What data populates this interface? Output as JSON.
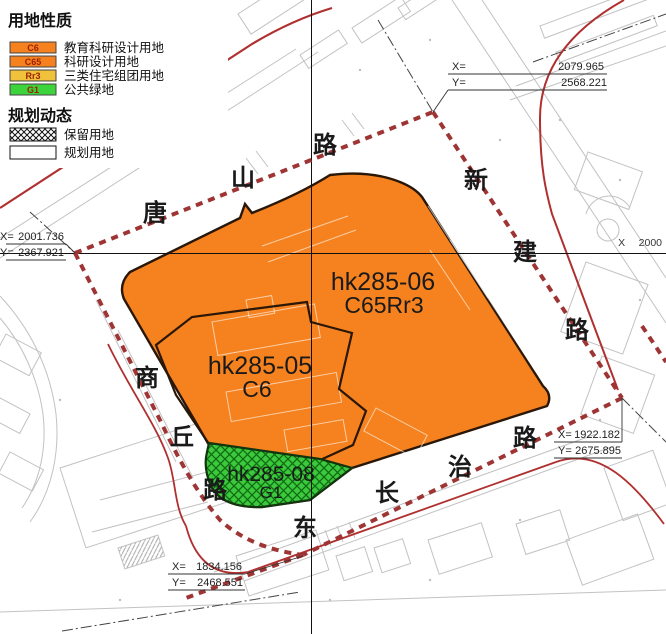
{
  "colors": {
    "parcel_orange": "#F5821F",
    "parcel_green": "#3DC93D",
    "boundary_red": "#9E3434",
    "label_maroon": "#8B1F1F"
  },
  "legend": {
    "title": "用地性质",
    "items": [
      {
        "code": "C6",
        "label": "教育科研设计用地",
        "color": "#F5821F"
      },
      {
        "code": "C65",
        "label": "科研设计用地",
        "color": "#F5821F"
      },
      {
        "code": "Rr3",
        "label": "三类住宅组团用地",
        "color": "#F0C23C"
      },
      {
        "code": "G1",
        "label": "公共绿地",
        "color": "#3DD33D"
      }
    ],
    "dynamics_title": "规划动态",
    "dynamics": [
      {
        "label": "保留用地"
      },
      {
        "label": "规划用地"
      }
    ]
  },
  "parcels": [
    {
      "id": "hk285-06",
      "code": "C65Rr3"
    },
    {
      "id": "hk285-05",
      "code": "C6"
    },
    {
      "id": "hk285-08",
      "code": "G1"
    }
  ],
  "roads": {
    "tangshan": [
      "唐",
      "山",
      "路"
    ],
    "xinjian": [
      "新",
      "建",
      "路"
    ],
    "shangqiu": [
      "商",
      "丘",
      "路"
    ],
    "changzhi": [
      "东",
      "长",
      "治",
      "路"
    ]
  },
  "coordinates": {
    "north": {
      "x_label": "X=",
      "x_value": "2079.965",
      "y_label": "Y=",
      "y_value": "2568.221"
    },
    "west": {
      "x_label": "X=",
      "x_value": "2001.736",
      "y_label": "Y=",
      "y_value": "2367.921"
    },
    "east": {
      "x_label": "X=",
      "x_value": "1922.182",
      "y_label": "Y=",
      "y_value": "2675.895"
    },
    "south": {
      "x_label": "X=",
      "x_value": "1834.156",
      "y_label": "Y=",
      "y_value": "2468.551"
    }
  },
  "grid_label": {
    "axis": "X",
    "value": "2000"
  }
}
